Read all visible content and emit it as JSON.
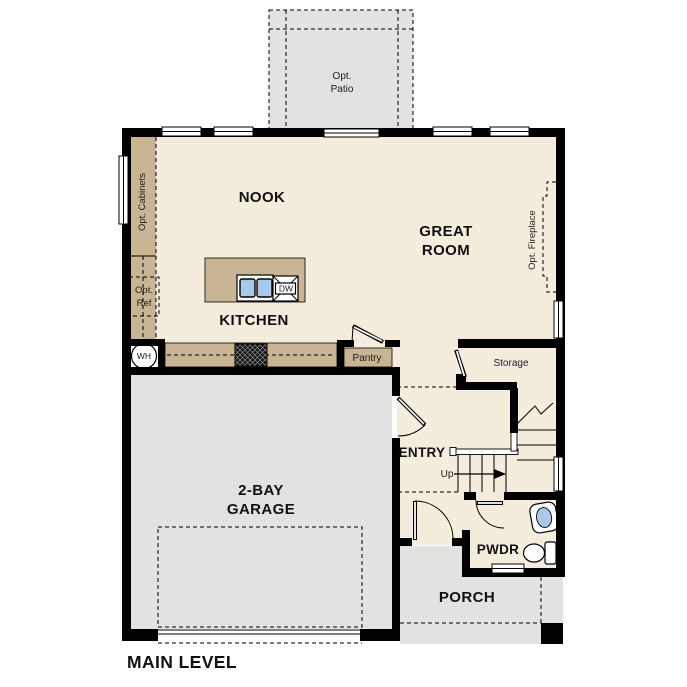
{
  "title": "MAIN LEVEL",
  "colors": {
    "floor": "#f4edde",
    "exterior_gray": "#e2e2e0",
    "cabinet_tan": "#c9b593",
    "wall_black": "#000000",
    "sink_blue": "#a9c9e9",
    "ref_gray": "#dcdcdc"
  },
  "rooms": {
    "nook": {
      "label": "NOOK"
    },
    "great_room": {
      "line1": "GREAT",
      "line2": "ROOM"
    },
    "kitchen": {
      "label": "KITCHEN"
    },
    "garage": {
      "line1": "2-BAY",
      "line2": "GARAGE"
    },
    "entry": {
      "label": "ENTRY"
    },
    "pwdr": {
      "label": "PWDR"
    },
    "porch": {
      "label": "PORCH"
    },
    "storage": {
      "label": "Storage"
    },
    "pantry": {
      "label": "Pantry"
    },
    "opt_patio": {
      "line1": "Opt.",
      "line2": "Patio"
    },
    "opt_cabinets": {
      "label": "Opt. Cabinets"
    },
    "opt_ref": {
      "line1": "Opt.",
      "line2": "Ref"
    },
    "opt_fireplace": {
      "label": "Opt. Fireplace"
    }
  },
  "fixtures": {
    "water_heater": "WH",
    "dishwasher": "DW",
    "stairs_up": "Up"
  }
}
